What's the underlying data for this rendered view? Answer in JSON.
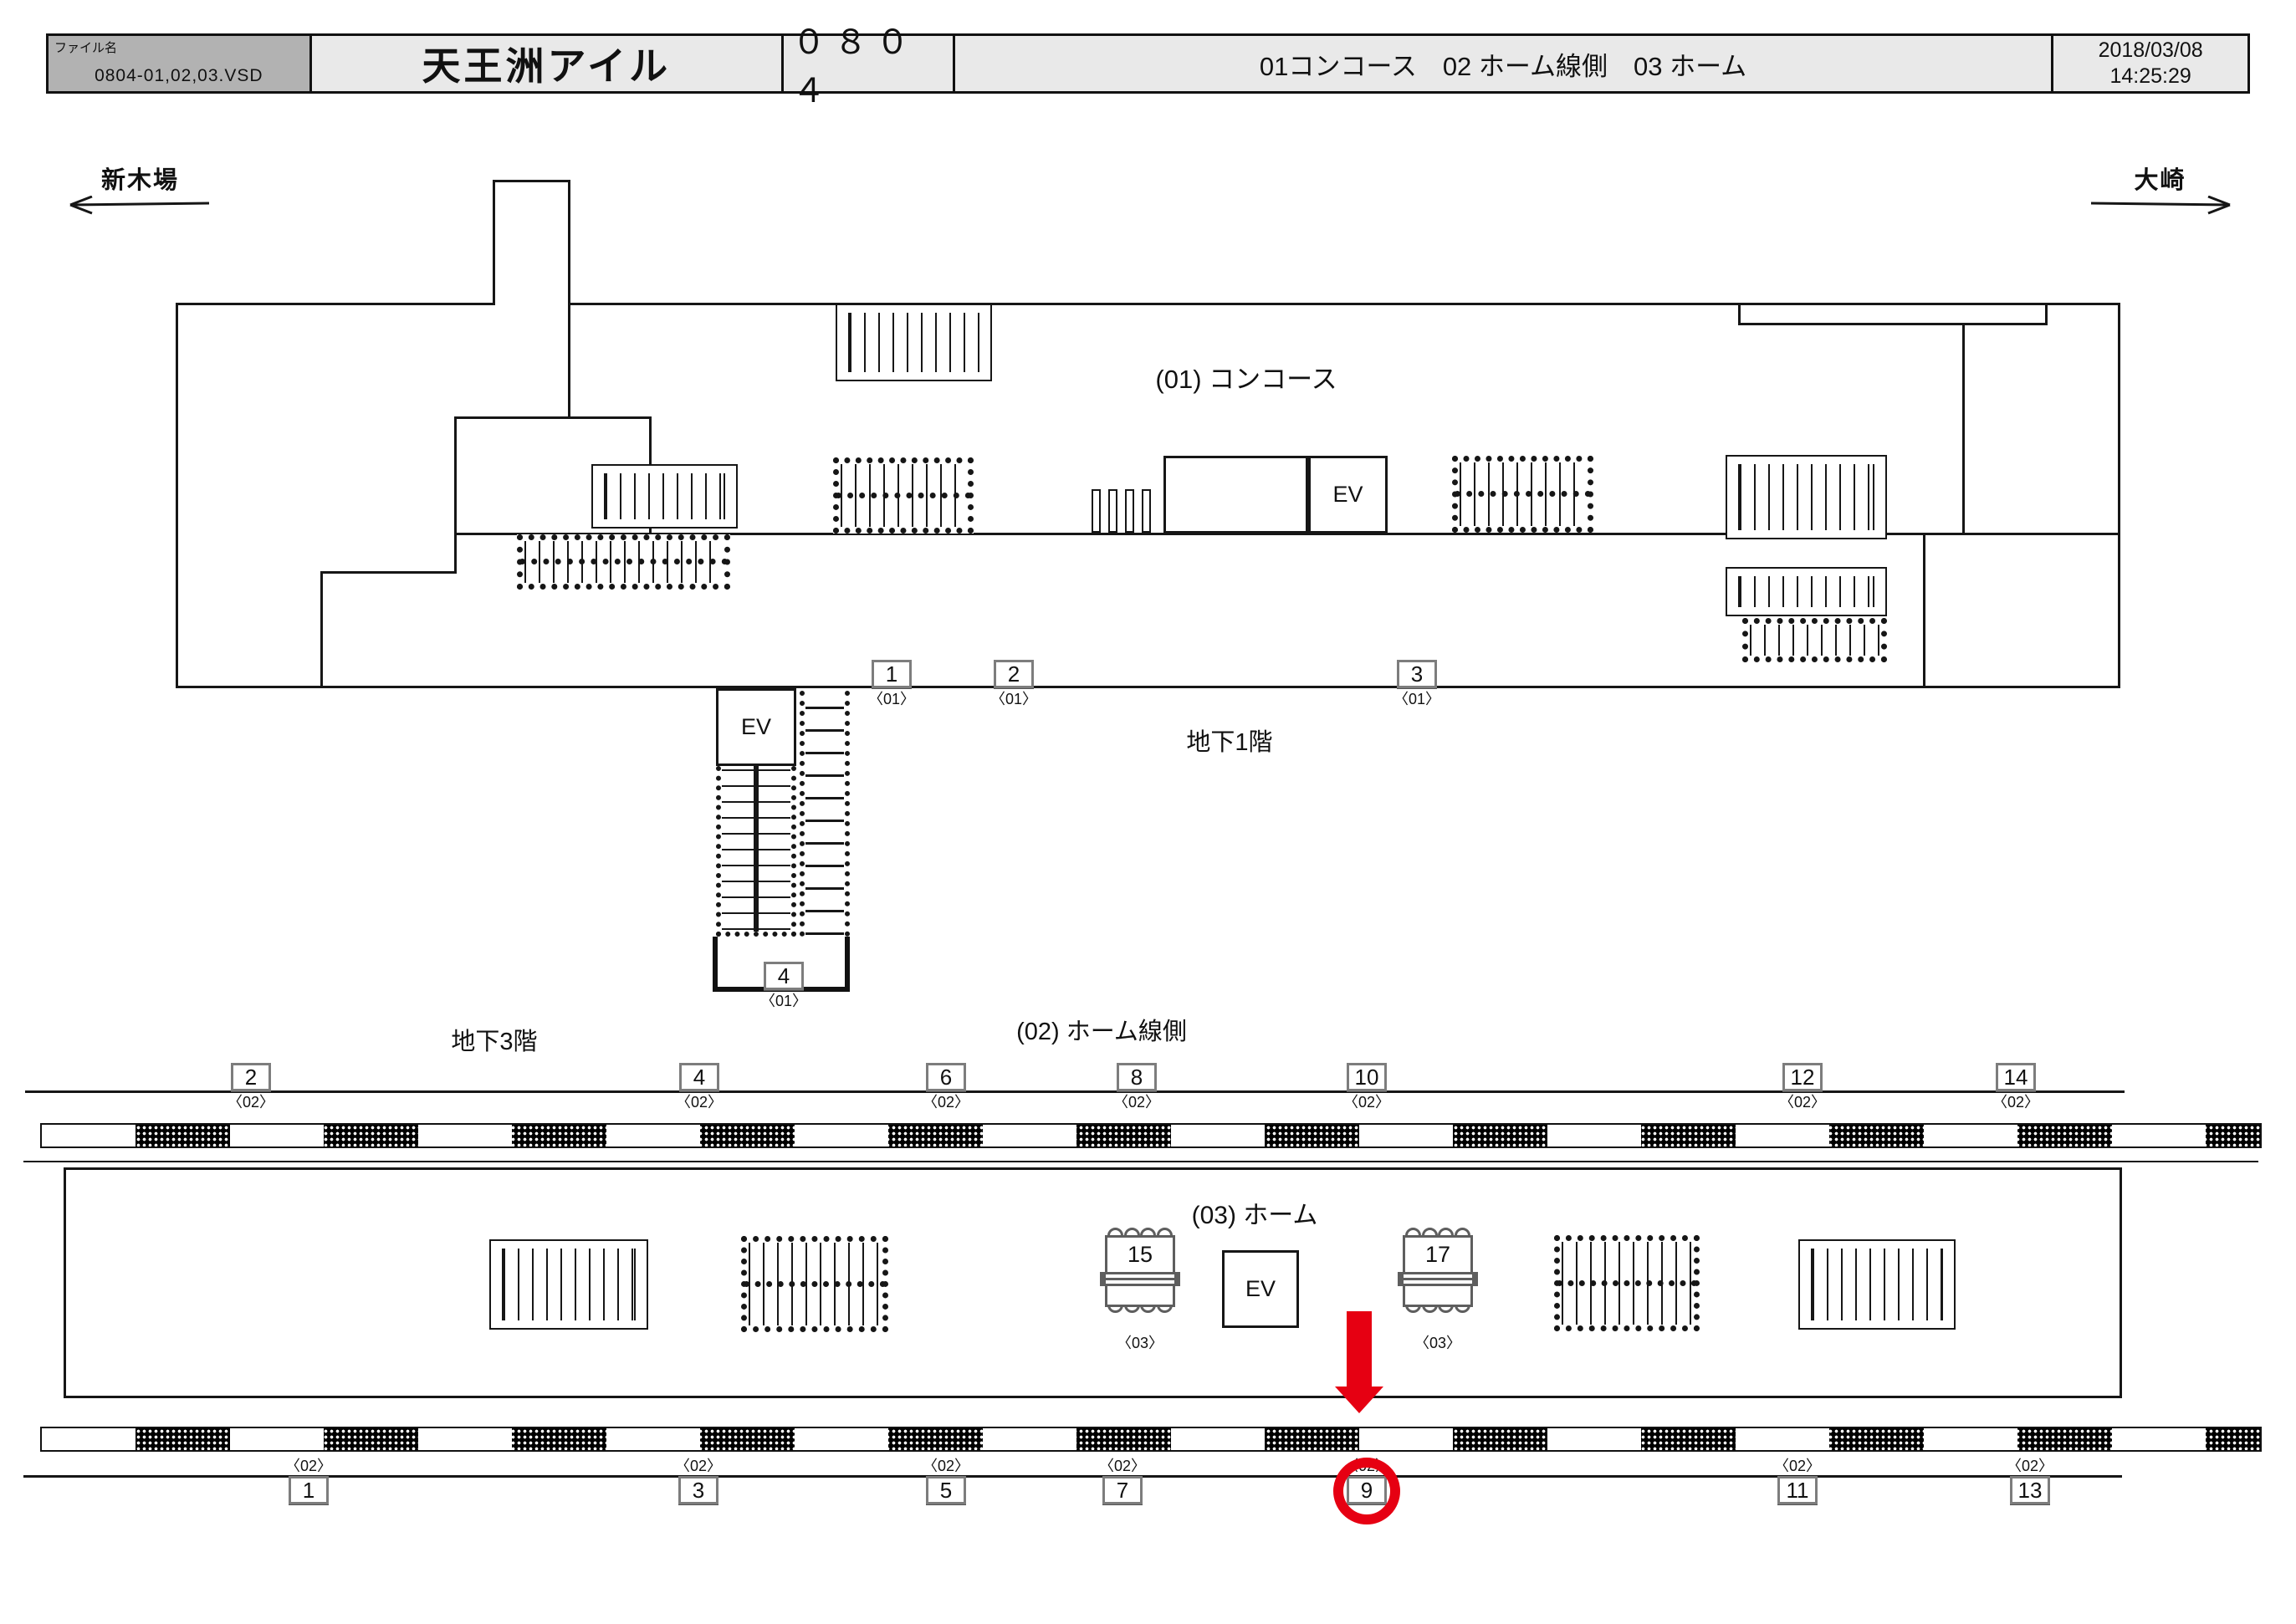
{
  "header": {
    "file_label": "ファイル名",
    "file_name": "0804-01,02,03.VSD",
    "station_name": "天王洲アイル",
    "station_code": "０８０４",
    "sections": "01コンコース　02 ホーム線側　03 ホーム",
    "date": "2018/03/08",
    "time": "14:25:29"
  },
  "directions": {
    "left": "新木場",
    "right": "大崎"
  },
  "labels": {
    "concourse": "(01) コンコース",
    "b1": "地下1階",
    "b3": "地下3階",
    "lineside": "(02) ホーム線側",
    "platform": "(03) ホーム",
    "ev": "EV"
  },
  "colors": {
    "highlight_red": "#e60012",
    "header_gray": "#b2b2b2",
    "header_light": "#e9e9e9"
  },
  "boxes": {
    "concourse_row": [
      {
        "no": "1",
        "cap": "〈01〉"
      },
      {
        "no": "2",
        "cap": "〈01〉"
      },
      {
        "no": "3",
        "cap": "〈01〉"
      }
    ],
    "shaft": {
      "no": "4",
      "cap": "〈01〉"
    },
    "lineside_row": [
      {
        "no": "2",
        "cap": "〈02〉"
      },
      {
        "no": "4",
        "cap": "〈02〉"
      },
      {
        "no": "6",
        "cap": "〈02〉"
      },
      {
        "no": "8",
        "cap": "〈02〉"
      },
      {
        "no": "10",
        "cap": "〈02〉"
      },
      {
        "no": "12",
        "cap": "〈02〉"
      },
      {
        "no": "14",
        "cap": "〈02〉"
      }
    ],
    "platform_signs": [
      {
        "no": "15",
        "cap": "〈03〉"
      },
      {
        "no": "17",
        "cap": "〈03〉"
      }
    ],
    "platform_row": [
      {
        "no": "1",
        "cap": "〈02〉"
      },
      {
        "no": "3",
        "cap": "〈02〉"
      },
      {
        "no": "5",
        "cap": "〈02〉"
      },
      {
        "no": "7",
        "cap": "〈02〉"
      },
      {
        "no": "9",
        "cap": "〈02〉",
        "highlighted": true
      },
      {
        "no": "11",
        "cap": "〈02〉"
      },
      {
        "no": "13",
        "cap": "〈02〉"
      }
    ],
    "highlighted_position": "9"
  }
}
